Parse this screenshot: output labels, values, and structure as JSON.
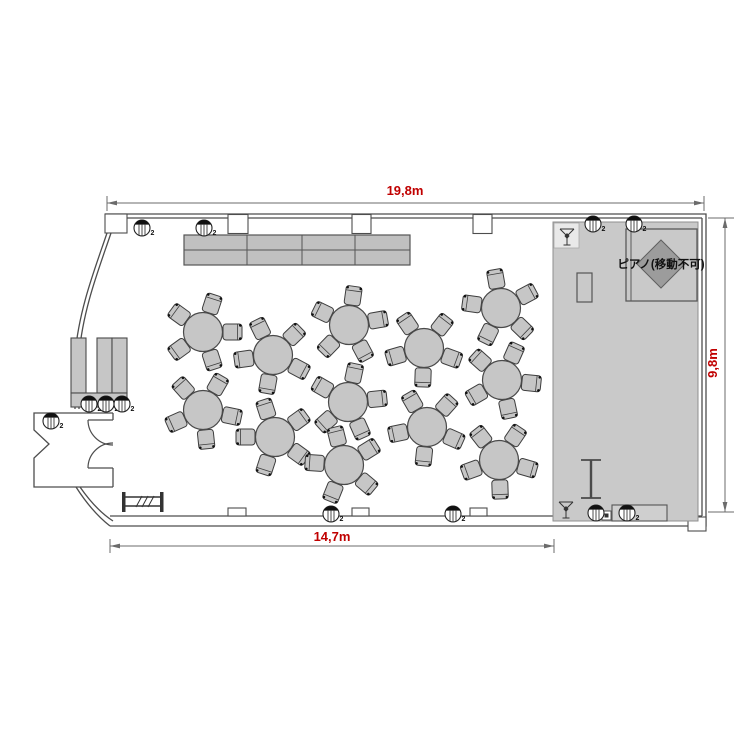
{
  "labels": {
    "top_dim": "19,8m",
    "right_dim": "9,8m",
    "bottom_dim": "14,7m",
    "piano": "ピアノ(移動不可)"
  },
  "colors": {
    "dimension_text": "#c00000",
    "dimension_line": "#6b6b6b",
    "wall": "#4d4d4d",
    "furniture_fill": "#c6c6c6",
    "furniture_stroke": "#3d3d3d",
    "stage_fill": "#c9c9c9",
    "stage_stroke": "#8f8f8f",
    "piano_diamond_fill": "#9c9c9c",
    "buffet_fill": "#c0c0c0",
    "icon_dark": "#111111"
  },
  "floorplan": {
    "tables": [
      {
        "x": 203,
        "y": 332,
        "angle": 18
      },
      {
        "x": 273,
        "y": 355,
        "angle": 46
      },
      {
        "x": 349,
        "y": 325,
        "angle": 8
      },
      {
        "x": 424,
        "y": 348,
        "angle": 38
      },
      {
        "x": 501,
        "y": 308,
        "angle": 62
      },
      {
        "x": 203,
        "y": 410,
        "angle": 30
      },
      {
        "x": 275,
        "y": 437,
        "angle": 54
      },
      {
        "x": 348,
        "y": 402,
        "angle": 12
      },
      {
        "x": 427,
        "y": 427,
        "angle": 42
      },
      {
        "x": 502,
        "y": 380,
        "angle": 24
      },
      {
        "x": 344,
        "y": 465,
        "angle": 58
      },
      {
        "x": 499,
        "y": 460,
        "angle": 34
      }
    ],
    "table_radius": 19.5,
    "chairs_per_table": 5,
    "downlights": [
      {
        "x": 142,
        "y": 228,
        "label": "2"
      },
      {
        "x": 204,
        "y": 228,
        "label": "2"
      },
      {
        "x": 593,
        "y": 224,
        "label": "2"
      },
      {
        "x": 634,
        "y": 224,
        "label": "2"
      },
      {
        "x": 89,
        "y": 404,
        "label": "2"
      },
      {
        "x": 106,
        "y": 404,
        "label": "2"
      },
      {
        "x": 122,
        "y": 404,
        "label": "2"
      },
      {
        "x": 51,
        "y": 421,
        "label": "2"
      },
      {
        "x": 331,
        "y": 514,
        "label": "2"
      },
      {
        "x": 453,
        "y": 514,
        "label": "2"
      },
      {
        "x": 596,
        "y": 513,
        "label": ""
      },
      {
        "x": 627,
        "y": 513,
        "label": "2"
      }
    ],
    "stands": [
      {
        "x": 567,
        "y": 236
      },
      {
        "x": 566,
        "y": 509
      }
    ]
  }
}
